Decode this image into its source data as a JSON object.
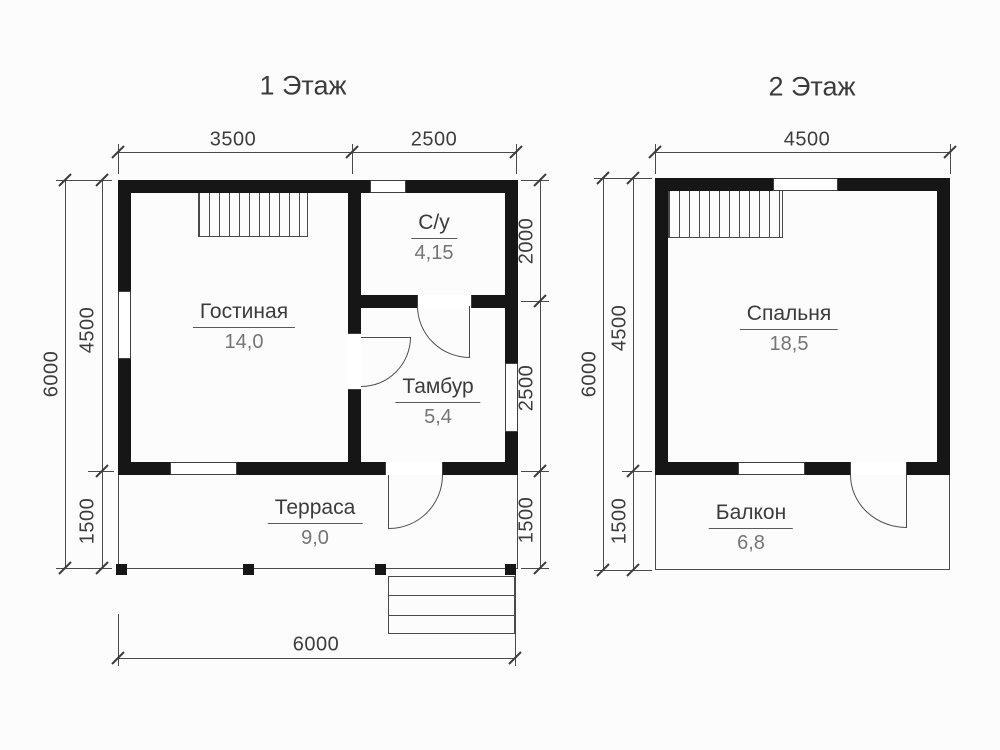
{
  "floor1": {
    "title": "1 Этаж",
    "rooms": {
      "living": {
        "name": "Гостиная",
        "area": "14,0"
      },
      "bathroom": {
        "name": "С/у",
        "area": "4,15"
      },
      "vestibule": {
        "name": "Тамбур",
        "area": "5,4"
      },
      "terrace": {
        "name": "Терраса",
        "area": "9,0"
      }
    },
    "dims": {
      "top_left": "3500",
      "top_right": "2500",
      "left_total": "6000",
      "left_main": "4500",
      "left_terrace": "1500",
      "right_bathroom": "2000",
      "right_vestibule": "2500",
      "right_terrace": "1500",
      "bottom_total": "6000"
    }
  },
  "floor2": {
    "title": "2 Этаж",
    "rooms": {
      "bedroom": {
        "name": "Спальня",
        "area": "18,5"
      },
      "balcony": {
        "name": "Балкон",
        "area": "6,8"
      }
    },
    "dims": {
      "top_total": "4500",
      "left_total": "6000",
      "left_main": "4500",
      "left_balcony": "1500"
    }
  },
  "colors": {
    "wall": "#161616",
    "thin_line": "#4a4a4a",
    "label_text": "#3b3b3b",
    "area_text": "#757575",
    "background": "#fcfcfc"
  }
}
